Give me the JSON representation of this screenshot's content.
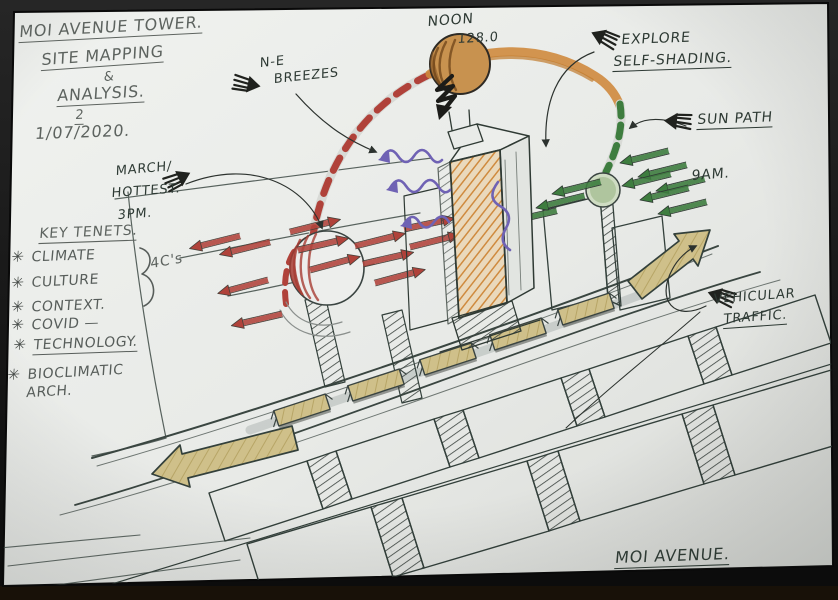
{
  "title_block": {
    "line1": "MOI AVENUE TOWER.",
    "line2": "SITE MAPPING",
    "ampersand": "&",
    "line3": "ANALYSIS.",
    "sub": "2",
    "date": "1/07/2020."
  },
  "key_tenets": {
    "heading": "KEY TENETS.",
    "bullet": "✳",
    "items": [
      "CLIMATE",
      "CULTURE",
      "CONTEXT.",
      "COVID —",
      "TECHNOLOGY.",
      "BIOCLIMATIC ARCH."
    ],
    "group_label": "4C's"
  },
  "callouts": {
    "ne_breezes": {
      "line1": "N-E",
      "line2": "BREEZES"
    },
    "noon": {
      "line1": "NOON",
      "line2": "128.0"
    },
    "explore": {
      "line1": "EXPLORE",
      "line2": "SELF-SHADING."
    },
    "sun_path": {
      "label": "SUN PATH"
    },
    "nine_am": {
      "label": "9AM."
    },
    "march": {
      "line1": "MARCH/",
      "line2": "HOTTEST.",
      "line3": "3PM."
    },
    "vehicular": {
      "line1": "VEHICULAR",
      "line2": "TRAFFIC."
    },
    "moi_avenue": {
      "label": "MOI AVENUE."
    }
  },
  "colors": {
    "paper": "#e9ebe8",
    "background": "#141414",
    "ink": "#33413b",
    "pencil": "#5d635f",
    "sun_red": "#b0423a",
    "sun_green": "#3e7d3f",
    "sun_orange": "#cf8a3e",
    "road_tan": "#cfc08a",
    "wind_purple": "#6f62b4"
  }
}
